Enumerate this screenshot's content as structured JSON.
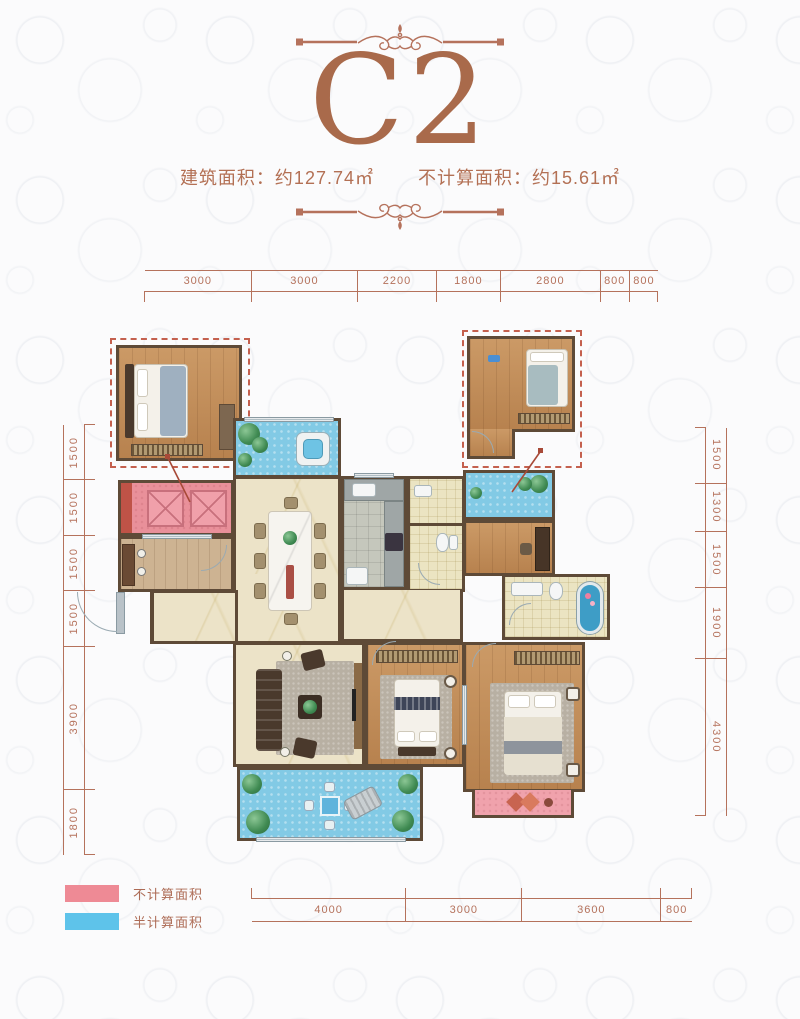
{
  "unit": {
    "title": "C2",
    "area_built_label": "建筑面积：约127.74㎡",
    "area_excluded_label": "不计算面积：约15.61㎡"
  },
  "dimensions": {
    "top": [
      "3000",
      "3000",
      "2200",
      "1800",
      "2800",
      "800",
      "800"
    ],
    "bottom": [
      "4000",
      "3000",
      "3600",
      "800"
    ],
    "left": [
      "1500",
      "1500",
      "1500",
      "1500",
      "3900",
      "1800"
    ],
    "right": [
      "1500",
      "1300",
      "1500",
      "1900",
      "4300"
    ]
  },
  "legend": {
    "items": [
      {
        "label": "不计算面积",
        "color": "#ee8a95"
      },
      {
        "label": "半计算面积",
        "color": "#5ec3ea"
      }
    ]
  },
  "colors": {
    "accent_copper": "#a96a4b",
    "dimension_line": "#b5725c",
    "wall": "#5e4a37",
    "wood_floor": "#c08a55",
    "marble_floor": "#ece3c8",
    "balcony_blue": "#82cae5",
    "excluded_pink": "#e9909a",
    "elevator_red": "#bf5347"
  }
}
